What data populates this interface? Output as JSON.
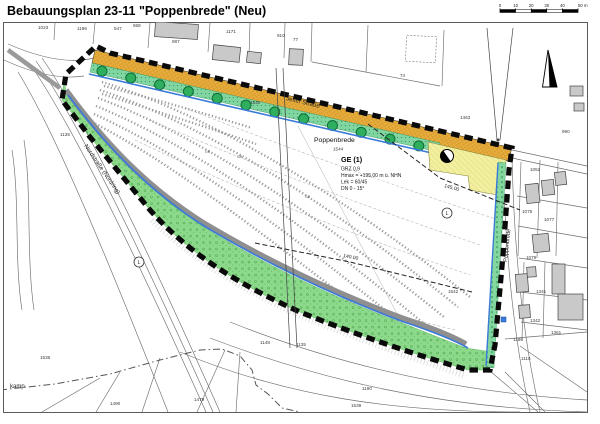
{
  "map": {
    "title": "Bebauungsplan 23-11 \"Poppenbrede\" (Neu)",
    "streets": {
      "jexer": "Jexer Straße",
      "nordstrasse": "Nordstraße (Nordring)",
      "poppenbrede": "Poppenbrede",
      "partial": "kamp"
    },
    "place": {
      "name": "Poppenbrede",
      "parcel": "1544"
    },
    "zone": {
      "title": "GE (1)",
      "lines": [
        "GRZ 0,9",
        "Hmax = +195,00 m ü. NHN",
        "Lek = 60/45",
        "DN 0 - 15°"
      ]
    },
    "contour_labels": [
      {
        "t": "145.00"
      },
      {
        "t": "140.00"
      }
    ],
    "l_marker": "L",
    "track_labels": [
      {
        "t": "GR",
        "x": 205,
        "y": 153
      },
      {
        "t": "GR",
        "x": 237,
        "y": 158
      },
      {
        "t": "GR",
        "x": 305,
        "y": 198
      }
    ],
    "parcel_numbers": [
      {
        "t": "1023",
        "x": 38,
        "y": 29
      },
      {
        "t": "1196",
        "x": 77,
        "y": 30
      },
      {
        "t": "547",
        "x": 114,
        "y": 30
      },
      {
        "t": "568",
        "x": 133,
        "y": 27
      },
      {
        "t": "987",
        "x": 172,
        "y": 43
      },
      {
        "t": "1171",
        "x": 226,
        "y": 33
      },
      {
        "t": "910",
        "x": 277,
        "y": 37
      },
      {
        "t": "77",
        "x": 293,
        "y": 41
      },
      {
        "t": "74",
        "x": 400,
        "y": 77
      },
      {
        "t": "1463",
        "x": 460,
        "y": 119
      },
      {
        "t": "990",
        "x": 562,
        "y": 133
      },
      {
        "t": "1540",
        "x": 250,
        "y": 104
      },
      {
        "t": "1135",
        "x": 60,
        "y": 136
      },
      {
        "t": "1052",
        "x": 530,
        "y": 171
      },
      {
        "t": "1075",
        "x": 522,
        "y": 213
      },
      {
        "t": "1077",
        "x": 544,
        "y": 221
      },
      {
        "t": "1079",
        "x": 526,
        "y": 259
      },
      {
        "t": "1542",
        "x": 448,
        "y": 293
      },
      {
        "t": "1341",
        "x": 536,
        "y": 293
      },
      {
        "t": "1342",
        "x": 530,
        "y": 322
      },
      {
        "t": "1361",
        "x": 551,
        "y": 334
      },
      {
        "t": "1186",
        "x": 513,
        "y": 341
      },
      {
        "t": "1116",
        "x": 521,
        "y": 360
      },
      {
        "t": "1536",
        "x": 40,
        "y": 359
      },
      {
        "t": "1490",
        "x": 110,
        "y": 405
      },
      {
        "t": "1479",
        "x": 194,
        "y": 401
      },
      {
        "t": "1148",
        "x": 260,
        "y": 344
      },
      {
        "t": "1135",
        "x": 296,
        "y": 346
      },
      {
        "t": "1190",
        "x": 362,
        "y": 390
      },
      {
        "t": "1539",
        "x": 351,
        "y": 407
      }
    ],
    "scale": {
      "ticks": [
        "0",
        "10",
        "20",
        "30",
        "40",
        "50 m"
      ]
    }
  },
  "colors": {
    "road": "#E7AC3C",
    "road_hatch": "#C08A1E",
    "green_area": "#8CD98C",
    "green_strip": "#80D5A1",
    "tree": "#2FAE5E",
    "pale_area": "#F2EFA0",
    "water_blue": "#3A7AD8",
    "path_gray": "#8F8F8F",
    "building": "#C9C9C9",
    "boundary": "#0A0A0A"
  }
}
